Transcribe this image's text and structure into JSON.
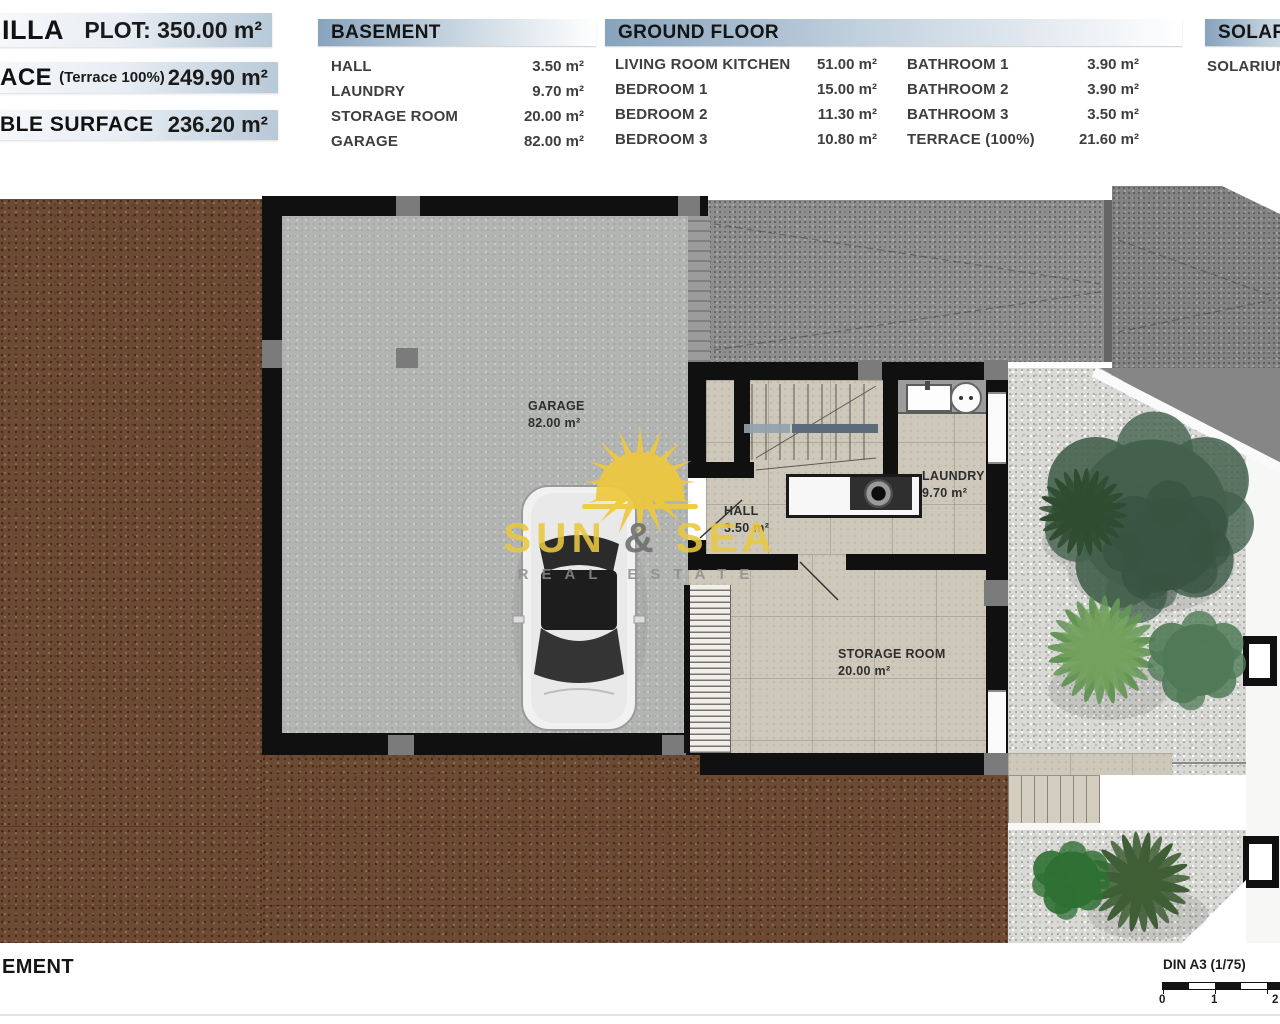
{
  "summary_bars": [
    {
      "label": "ILLA",
      "note": "",
      "value": "PLOT: 350.00 m²"
    },
    {
      "label": "ACE",
      "note": "(Terrace 100%)",
      "value": "249.90 m²"
    },
    {
      "label": "BLE SURFACE",
      "note": "",
      "value": "236.20 m²"
    }
  ],
  "basement_table": {
    "title": "BASEMENT",
    "rows": [
      {
        "label": "HALL",
        "value": "3.50 m²"
      },
      {
        "label": "LAUNDRY",
        "value": "9.70 m²"
      },
      {
        "label": "STORAGE ROOM",
        "value": "20.00 m²"
      },
      {
        "label": "GARAGE",
        "value": "82.00 m²"
      }
    ]
  },
  "ground_floor_table": {
    "title": "GROUND FLOOR",
    "col1": [
      {
        "label": "LIVING ROOM KITCHEN",
        "value": "51.00 m²"
      },
      {
        "label": "BEDROOM 1",
        "value": "15.00 m²"
      },
      {
        "label": "BEDROOM 2",
        "value": "11.30 m²"
      },
      {
        "label": "BEDROOM 3",
        "value": "10.80 m²"
      }
    ],
    "col2": [
      {
        "label": "BATHROOM 1",
        "value": "3.90 m²"
      },
      {
        "label": "BATHROOM 2",
        "value": "3.90 m²"
      },
      {
        "label": "BATHROOM 3",
        "value": "3.50 m²"
      },
      {
        "label": "TERRACE (100%)",
        "value": "21.60 m²"
      }
    ]
  },
  "solarium_table": {
    "title": "SOLARIUM",
    "rows": [
      {
        "label": "SOLARIUM",
        "value": ""
      }
    ]
  },
  "plan": {
    "rooms": {
      "garage": {
        "name": "GARAGE",
        "area": "82.00 m²"
      },
      "hall": {
        "name": "HALL",
        "area": "3.50 m²"
      },
      "laundry": {
        "name": "LAUNDRY",
        "area": "9.70 m²"
      },
      "storage": {
        "name": "STORAGE ROOM",
        "area": "20.00 m²"
      }
    },
    "watermark": {
      "word1": "SUN",
      "amp": "&",
      "word2": "SEA",
      "subtitle": "REAL ESTATE"
    }
  },
  "footer": {
    "plan_title": "EMENT",
    "sheet_label": "DIN A3 (1/75)",
    "scale_ticks": [
      "0",
      "1",
      "2"
    ]
  },
  "colors": {
    "header_accent": "#87a3bd",
    "dirt_brown": "#6d4a34",
    "gravel_gray": "#d9d9d5",
    "asphalt_gray": "#8e8e8e",
    "garage_floor": "#b3b5b3",
    "tile_beige": "#cec8bb",
    "sun_yellow": "#eac73e"
  }
}
